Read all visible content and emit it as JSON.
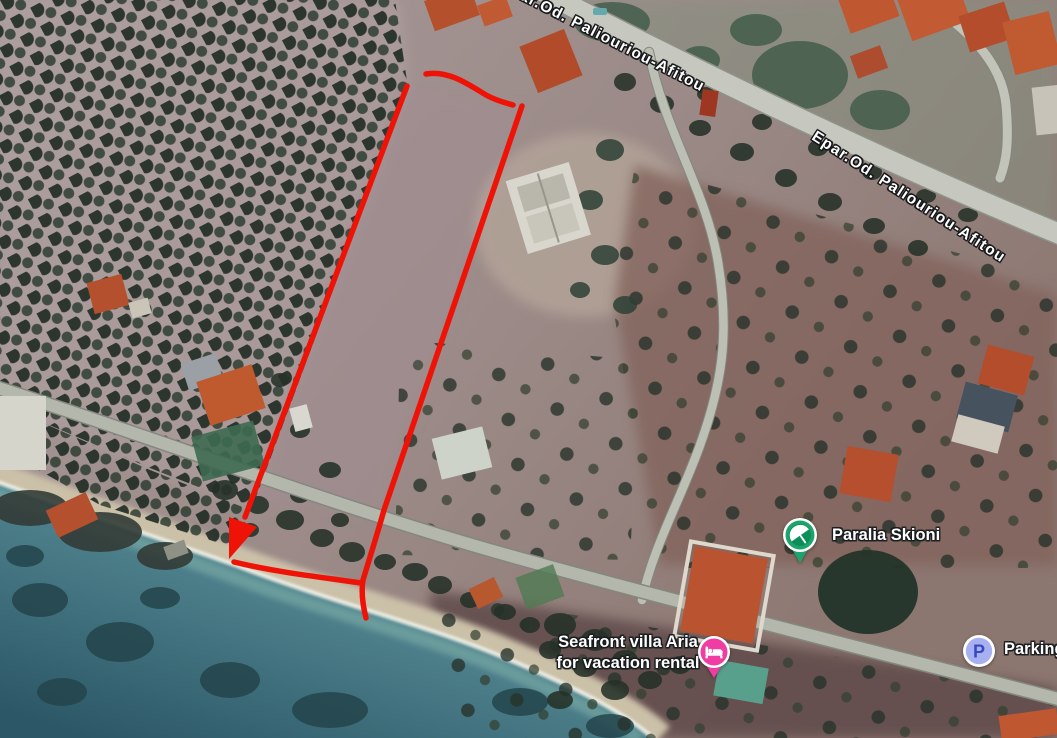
{
  "map": {
    "type": "satellite-aerial-view",
    "road_labels": [
      {
        "name": "Epar.Od. Paliouriou-Afitou",
        "note": "clipped at top edge, only '. Paliouriou-Afitou' visible"
      },
      {
        "name": "Epar.Od. Paliouriou-Afitou"
      }
    ],
    "pois": [
      {
        "label": "Paralia Skioni",
        "icon": "beach-umbrella-icon",
        "pin_color": "#1ba56c",
        "pin_inner_color": "#0d8e58"
      },
      {
        "label_line1": "Seafront villa Aria",
        "label_line2": "for vacation rental",
        "icon": "bed-icon",
        "pin_color": "#ef3da4"
      },
      {
        "label": "Parking",
        "icon": "parking-icon",
        "glyph": "P",
        "pin_color": "#a7b1f2",
        "glyph_color": "#3a49c0"
      }
    ],
    "annotation": {
      "type": "property-boundary-with-arrow",
      "color": "#ee1306"
    }
  },
  "colors": {
    "sea_deep": "#2c5766",
    "sea_shallow": "#9dc3b4",
    "olive_grove_ground": "#b2a2a2",
    "field_mauve": "#a18d92",
    "field_brown": "#82645b",
    "road_grey": "#c6c8bf",
    "label_text": "#ffffff"
  }
}
